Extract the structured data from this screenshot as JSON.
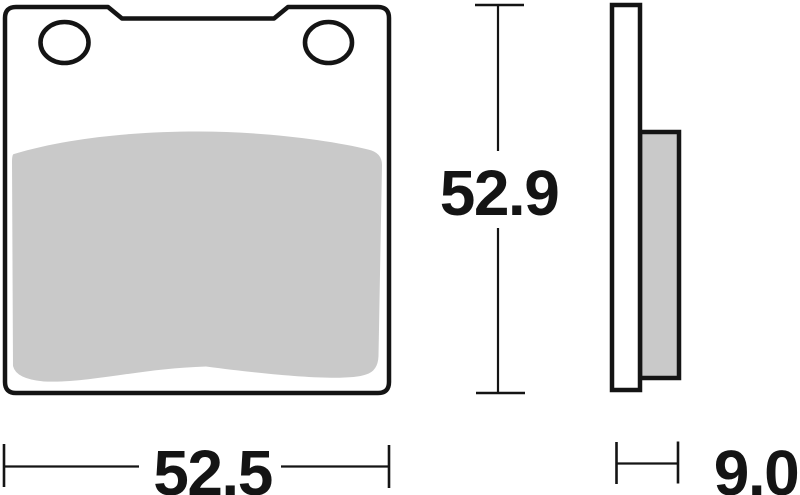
{
  "dimensions": {
    "height_mm": "52.9",
    "width_mm": "52.5",
    "thickness_mm": "9.0"
  },
  "colors": {
    "ink": "#141414",
    "friction_gray": "#c9c9c9",
    "background": "#ffffff"
  }
}
